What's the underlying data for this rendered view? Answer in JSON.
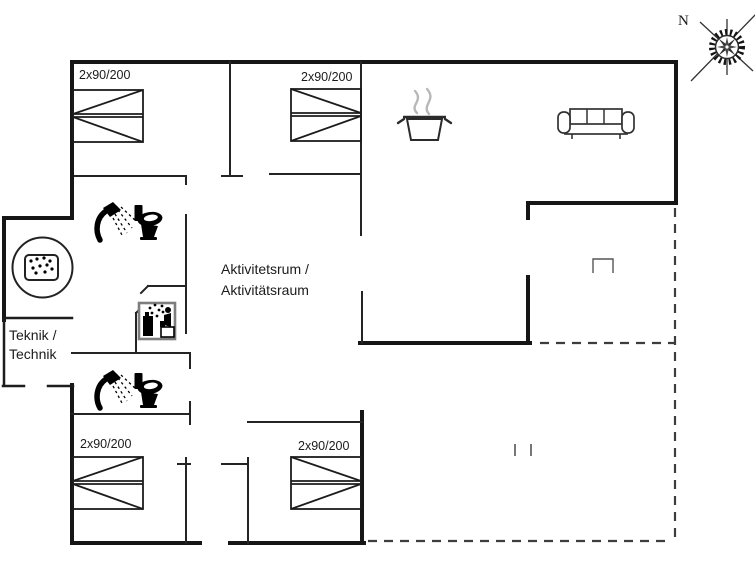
{
  "floorplan": {
    "compass": {
      "label": "N"
    },
    "room_labels": {
      "activity_room_line1": "Aktivitetsrum /",
      "activity_room_line2": "Aktivitätsraum",
      "technik_room_line1": "Teknik /",
      "technik_room_line2": "Technik"
    },
    "bed_label": "2x90/200",
    "bed_count": 4,
    "icons": [
      "compass-rose-icon",
      "double-bed-icon",
      "shower-icon",
      "toilet-icon",
      "washing-machine-icon",
      "whirlpool-icon",
      "cooking-pot-icon",
      "steam-icon",
      "sofa-icon"
    ],
    "colors": {
      "exterior_wall": "#161616",
      "interior_wall": "#242424",
      "terrace_dashed": "#3d3d3d",
      "steam_gray": "#b8b8b8",
      "icon_frame_gray": "#7d7d7d",
      "background": "#ffffff"
    }
  }
}
